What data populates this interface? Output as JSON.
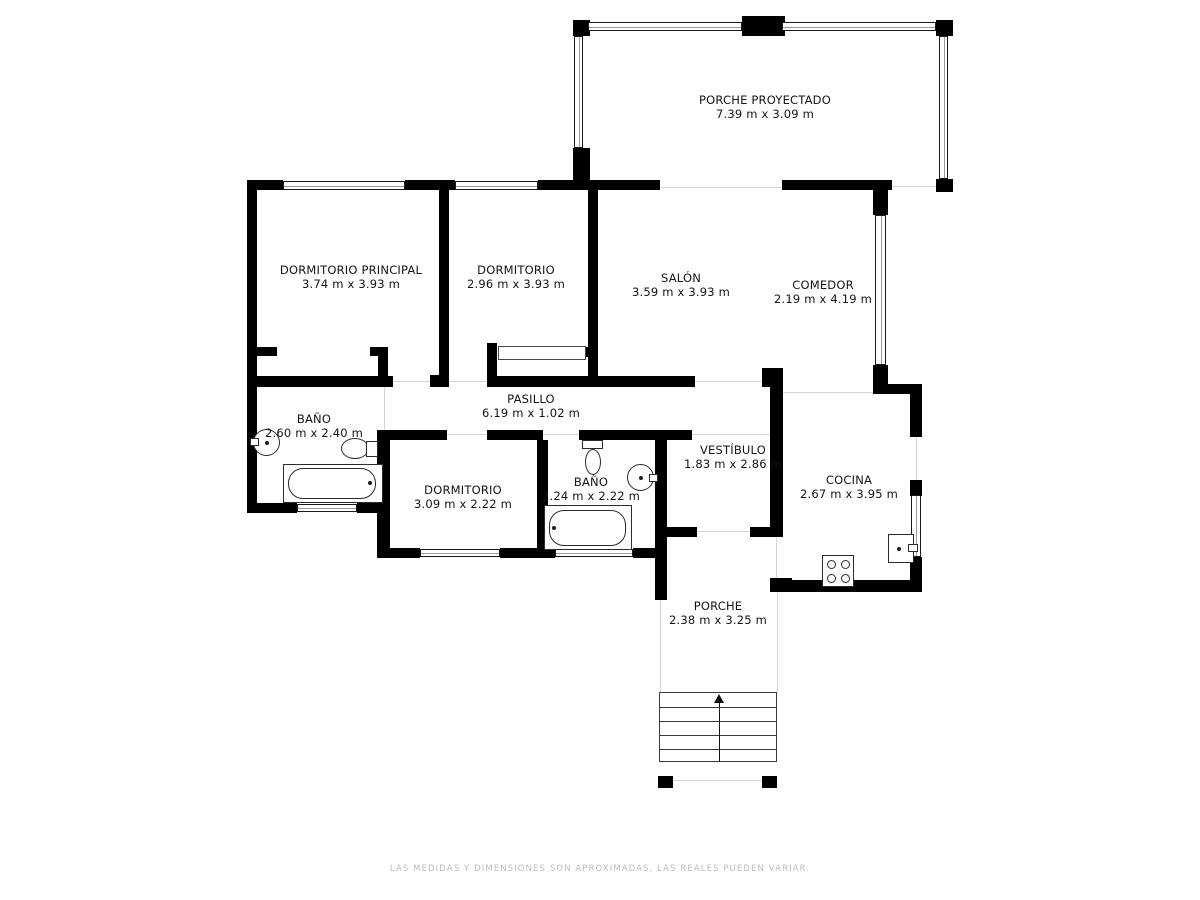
{
  "footer": {
    "text": "LAS MEDIDAS Y DIMENSIONES SON APROXIMADAS, LAS REALES PUEDEN VARIAR."
  },
  "colors": {
    "wall": "#000000",
    "fixture_line": "#2b2b2b",
    "faint_line": "#d4d4d4",
    "label": "#141414",
    "footer": "#bcbcbc"
  },
  "plan": {
    "rooms": [
      {
        "id": "porche-proyectado",
        "name": "PORCHE PROYECTADO",
        "dims": "7.39 m x 3.09 m",
        "cx": 765,
        "cy": 107
      },
      {
        "id": "dormitorio-principal",
        "name": "DORMITORIO PRINCIPAL",
        "dims": "3.74 m x 3.93 m",
        "cx": 351,
        "cy": 277
      },
      {
        "id": "dormitorio",
        "name": "DORMITORIO",
        "dims": "2.96 m x 3.93 m",
        "cx": 516,
        "cy": 277
      },
      {
        "id": "salon",
        "name": "SALÓN",
        "dims": "3.59 m x 3.93 m",
        "cx": 681,
        "cy": 285
      },
      {
        "id": "comedor",
        "name": "COMEDOR",
        "dims": "2.19 m x 4.19 m",
        "cx": 823,
        "cy": 292
      },
      {
        "id": "pasillo",
        "name": "PASILLO",
        "dims": "6.19 m x 1.02 m",
        "cx": 531,
        "cy": 406
      },
      {
        "id": "bano-1",
        "name": "BAÑO",
        "dims": "2.60 m x 2.40 m",
        "cx": 314,
        "cy": 426
      },
      {
        "id": "dormitorio-3",
        "name": "DORMITORIO",
        "dims": "3.09 m x 2.22 m",
        "cx": 463,
        "cy": 497
      },
      {
        "id": "bano-2",
        "name": "BAÑO",
        "dims": "2.24 m x 2.22 m",
        "cx": 591,
        "cy": 489
      },
      {
        "id": "vestibulo",
        "name": "VESTÍBULO",
        "dims": "1.83 m x 2.86 m",
        "cx": 733,
        "cy": 457
      },
      {
        "id": "cocina",
        "name": "COCINA",
        "dims": "2.67 m x 3.95 m",
        "cx": 849,
        "cy": 487
      },
      {
        "id": "porche",
        "name": "PORCHE",
        "dims": "2.38 m x 3.25 m",
        "cx": 718,
        "cy": 613
      }
    ],
    "walls": [
      {
        "x": 573,
        "y": 20,
        "w": 17,
        "h": 16
      },
      {
        "x": 936,
        "y": 20,
        "w": 17,
        "h": 16
      },
      {
        "x": 742,
        "y": 16,
        "w": 43,
        "h": 20
      },
      {
        "x": 573,
        "y": 148,
        "w": 17,
        "h": 32
      },
      {
        "x": 936,
        "y": 179,
        "w": 17,
        "h": 13
      },
      {
        "x": 247,
        "y": 180,
        "w": 36,
        "h": 10
      },
      {
        "x": 405,
        "y": 180,
        "w": 50,
        "h": 10
      },
      {
        "x": 538,
        "y": 180,
        "w": 122,
        "h": 10
      },
      {
        "x": 782,
        "y": 180,
        "w": 110,
        "h": 10
      },
      {
        "x": 247,
        "y": 180,
        "w": 10,
        "h": 333
      },
      {
        "x": 439,
        "y": 190,
        "w": 10,
        "h": 188
      },
      {
        "x": 430,
        "y": 375,
        "w": 19,
        "h": 12
      },
      {
        "x": 588,
        "y": 190,
        "w": 10,
        "h": 197
      },
      {
        "x": 578,
        "y": 347,
        "w": 10,
        "h": 10
      },
      {
        "x": 487,
        "y": 343,
        "w": 10,
        "h": 44
      },
      {
        "x": 257,
        "y": 347,
        "w": 20,
        "h": 9
      },
      {
        "x": 370,
        "y": 347,
        "w": 18,
        "h": 9
      },
      {
        "x": 378,
        "y": 355,
        "w": 10,
        "h": 21
      },
      {
        "x": 247,
        "y": 376,
        "w": 146,
        "h": 11
      },
      {
        "x": 487,
        "y": 376,
        "w": 101,
        "h": 11
      },
      {
        "x": 598,
        "y": 376,
        "w": 97,
        "h": 11
      },
      {
        "x": 762,
        "y": 368,
        "w": 21,
        "h": 19
      },
      {
        "x": 390,
        "y": 430,
        "w": 57,
        "h": 10
      },
      {
        "x": 487,
        "y": 430,
        "w": 56,
        "h": 10
      },
      {
        "x": 579,
        "y": 430,
        "w": 113,
        "h": 10
      },
      {
        "x": 377,
        "y": 430,
        "w": 13,
        "h": 127
      },
      {
        "x": 537,
        "y": 440,
        "w": 11,
        "h": 112
      },
      {
        "x": 655,
        "y": 440,
        "w": 12,
        "h": 110
      },
      {
        "x": 655,
        "y": 527,
        "w": 12,
        "h": 73
      },
      {
        "x": 247,
        "y": 503,
        "w": 50,
        "h": 10
      },
      {
        "x": 357,
        "y": 503,
        "w": 33,
        "h": 10
      },
      {
        "x": 377,
        "y": 548,
        "w": 43,
        "h": 10
      },
      {
        "x": 500,
        "y": 548,
        "w": 55,
        "h": 10
      },
      {
        "x": 633,
        "y": 548,
        "w": 34,
        "h": 10
      },
      {
        "x": 667,
        "y": 527,
        "w": 30,
        "h": 10
      },
      {
        "x": 750,
        "y": 527,
        "w": 33,
        "h": 10
      },
      {
        "x": 770,
        "y": 368,
        "w": 13,
        "h": 165
      },
      {
        "x": 770,
        "y": 578,
        "w": 22,
        "h": 14
      },
      {
        "x": 770,
        "y": 580,
        "w": 150,
        "h": 12
      },
      {
        "x": 910,
        "y": 384,
        "w": 12,
        "h": 53
      },
      {
        "x": 910,
        "y": 480,
        "w": 12,
        "h": 16
      },
      {
        "x": 910,
        "y": 557,
        "w": 12,
        "h": 35
      },
      {
        "x": 873,
        "y": 384,
        "w": 49,
        "h": 10
      },
      {
        "x": 873,
        "y": 180,
        "w": 15,
        "h": 35
      },
      {
        "x": 873,
        "y": 365,
        "w": 15,
        "h": 29
      },
      {
        "x": 658,
        "y": 776,
        "w": 15,
        "h": 12
      },
      {
        "x": 762,
        "y": 776,
        "w": 15,
        "h": 12
      }
    ],
    "windows": [
      {
        "x": 588,
        "y": 22,
        "w": 154,
        "h": 9,
        "o": "h"
      },
      {
        "x": 782,
        "y": 22,
        "w": 154,
        "h": 9,
        "o": "h"
      },
      {
        "x": 574,
        "y": 36,
        "w": 9,
        "h": 112,
        "o": "v"
      },
      {
        "x": 939,
        "y": 36,
        "w": 9,
        "h": 143,
        "o": "v"
      },
      {
        "x": 283,
        "y": 181,
        "w": 122,
        "h": 9,
        "o": "h"
      },
      {
        "x": 455,
        "y": 181,
        "w": 83,
        "h": 9,
        "o": "h"
      },
      {
        "x": 875,
        "y": 215,
        "w": 11,
        "h": 150,
        "o": "v"
      },
      {
        "x": 911,
        "y": 495,
        "w": 10,
        "h": 62,
        "o": "v"
      },
      {
        "x": 297,
        "y": 504,
        "w": 60,
        "h": 8,
        "o": "h"
      },
      {
        "x": 420,
        "y": 549,
        "w": 80,
        "h": 8,
        "o": "h"
      },
      {
        "x": 555,
        "y": 549,
        "w": 78,
        "h": 8,
        "o": "h"
      }
    ],
    "faint_lines": [
      {
        "x": 660,
        "y": 187,
        "w": 122,
        "h": 1
      },
      {
        "x": 892,
        "y": 186,
        "w": 45,
        "h": 1
      },
      {
        "x": 393,
        "y": 381,
        "w": 37,
        "h": 1
      },
      {
        "x": 449,
        "y": 381,
        "w": 38,
        "h": 1
      },
      {
        "x": 695,
        "y": 381,
        "w": 67,
        "h": 1
      },
      {
        "x": 447,
        "y": 434,
        "w": 40,
        "h": 1
      },
      {
        "x": 543,
        "y": 434,
        "w": 36,
        "h": 1
      },
      {
        "x": 692,
        "y": 434,
        "w": 78,
        "h": 1
      },
      {
        "x": 697,
        "y": 531,
        "w": 53,
        "h": 1
      },
      {
        "x": 776,
        "y": 533,
        "w": 1,
        "h": 45
      },
      {
        "x": 783,
        "y": 392,
        "w": 90,
        "h": 1
      },
      {
        "x": 384,
        "y": 387,
        "w": 1,
        "h": 43
      },
      {
        "x": 916,
        "y": 437,
        "w": 1,
        "h": 43
      },
      {
        "x": 660,
        "y": 600,
        "w": 1,
        "h": 92
      },
      {
        "x": 777,
        "y": 592,
        "w": 1,
        "h": 100
      },
      {
        "x": 672,
        "y": 780,
        "w": 90,
        "h": 1
      }
    ],
    "thin_rects": [
      {
        "x": 498,
        "y": 346,
        "w": 88,
        "h": 14,
        "name": "wardrobe"
      }
    ],
    "fixtures": [
      {
        "shape": "ellipse",
        "x": 253,
        "y": 429,
        "w": 27,
        "h": 27,
        "name": "sink"
      },
      {
        "shape": "dot",
        "x": 265,
        "y": 441,
        "w": 4,
        "h": 4,
        "name": "sink-drain"
      },
      {
        "shape": "rect",
        "x": 250,
        "y": 438,
        "w": 9,
        "h": 8,
        "name": "tap"
      },
      {
        "shape": "ellipse",
        "x": 341,
        "y": 438,
        "w": 28,
        "h": 21,
        "name": "toilet-bowl"
      },
      {
        "shape": "rect",
        "x": 366,
        "y": 441,
        "w": 12,
        "h": 16,
        "name": "toilet-tank"
      },
      {
        "shape": "rect",
        "x": 283,
        "y": 464,
        "w": 100,
        "h": 39,
        "name": "bathtub"
      },
      {
        "shape": "rounded",
        "x": 288,
        "y": 468,
        "w": 88,
        "h": 31,
        "name": "bathtub-basin"
      },
      {
        "shape": "dot",
        "x": 368,
        "y": 481,
        "w": 4,
        "h": 4,
        "name": "bathtub-tap"
      },
      {
        "shape": "rect",
        "x": 582,
        "y": 440,
        "w": 21,
        "h": 9,
        "name": "toilet-tank"
      },
      {
        "shape": "ellipse",
        "x": 585,
        "y": 449,
        "w": 16,
        "h": 26,
        "name": "toilet-bowl"
      },
      {
        "shape": "ellipse",
        "x": 627,
        "y": 464,
        "w": 27,
        "h": 27,
        "name": "sink"
      },
      {
        "shape": "dot",
        "x": 639,
        "y": 476,
        "w": 4,
        "h": 4,
        "name": "sink-drain"
      },
      {
        "shape": "rect",
        "x": 649,
        "y": 474,
        "w": 9,
        "h": 8,
        "name": "tap"
      },
      {
        "shape": "rect",
        "x": 544,
        "y": 505,
        "w": 88,
        "h": 45,
        "name": "bathtub"
      },
      {
        "shape": "rounded",
        "x": 549,
        "y": 510,
        "w": 77,
        "h": 36,
        "name": "bathtub-basin"
      },
      {
        "shape": "dot",
        "x": 552,
        "y": 526,
        "w": 4,
        "h": 4,
        "name": "bathtub-tap"
      },
      {
        "shape": "rect",
        "x": 822,
        "y": 555,
        "w": 32,
        "h": 32,
        "name": "stove"
      },
      {
        "shape": "ellipse",
        "x": 827,
        "y": 560,
        "w": 9,
        "h": 9,
        "name": "burner"
      },
      {
        "shape": "ellipse",
        "x": 841,
        "y": 560,
        "w": 9,
        "h": 9,
        "name": "burner"
      },
      {
        "shape": "ellipse",
        "x": 827,
        "y": 574,
        "w": 9,
        "h": 9,
        "name": "burner"
      },
      {
        "shape": "ellipse",
        "x": 841,
        "y": 574,
        "w": 9,
        "h": 9,
        "name": "burner"
      },
      {
        "shape": "rect",
        "x": 888,
        "y": 534,
        "w": 26,
        "h": 29,
        "name": "kitchen-sink"
      },
      {
        "shape": "dot",
        "x": 897,
        "y": 547,
        "w": 4,
        "h": 4,
        "name": "sink-drain"
      },
      {
        "shape": "rect",
        "x": 908,
        "y": 544,
        "w": 10,
        "h": 8,
        "name": "tap"
      }
    ],
    "stairs": {
      "x": 659,
      "y": 692,
      "w": 118,
      "h": 70,
      "steps": 5
    }
  }
}
